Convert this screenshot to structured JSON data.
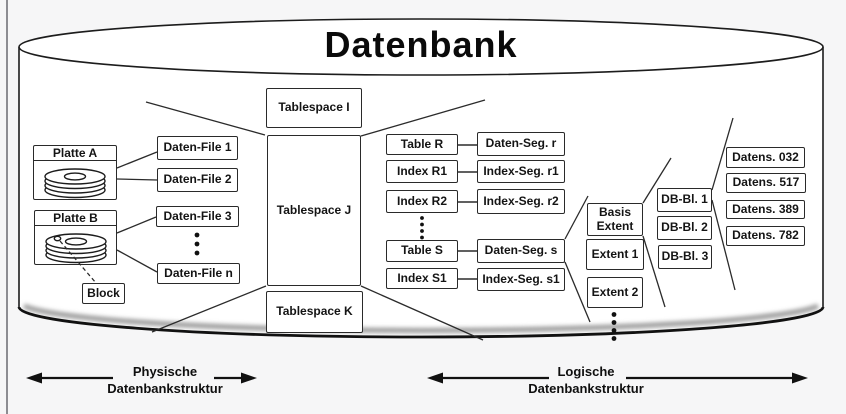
{
  "title": "Datenbank",
  "physical": {
    "platte_a": "Platte A",
    "platte_b": "Platte B",
    "block": "Block",
    "files": [
      "Daten-File 1",
      "Daten-File 2",
      "Daten-File 3",
      "Daten-File n"
    ]
  },
  "tablespaces": [
    "Tablespace I",
    "Tablespace J",
    "Tablespace K"
  ],
  "tables": [
    "Table R",
    "Index R1",
    "Index R2",
    "Table S",
    "Index S1"
  ],
  "segments": [
    "Daten-Seg. r",
    "Index-Seg. r1",
    "Index-Seg. r2",
    "Daten-Seg. s",
    "Index-Seg. s1"
  ],
  "extents": [
    "Basis Extent",
    "Extent 1",
    "Extent 2"
  ],
  "db_blocks": [
    "DB-Bl. 1",
    "DB-Bl. 2",
    "DB-Bl. 3"
  ],
  "records": [
    "Datens. 032",
    "Datens. 517",
    "Datens. 389",
    "Datens. 782"
  ],
  "legend": {
    "physical": [
      "Physische",
      "Datenbankstruktur"
    ],
    "logical": [
      "Logische",
      "Datenbankstruktur"
    ]
  },
  "colors": {
    "ink": "#1c1c1c",
    "surface": "#ffffff",
    "background": "#f6f6f7"
  }
}
